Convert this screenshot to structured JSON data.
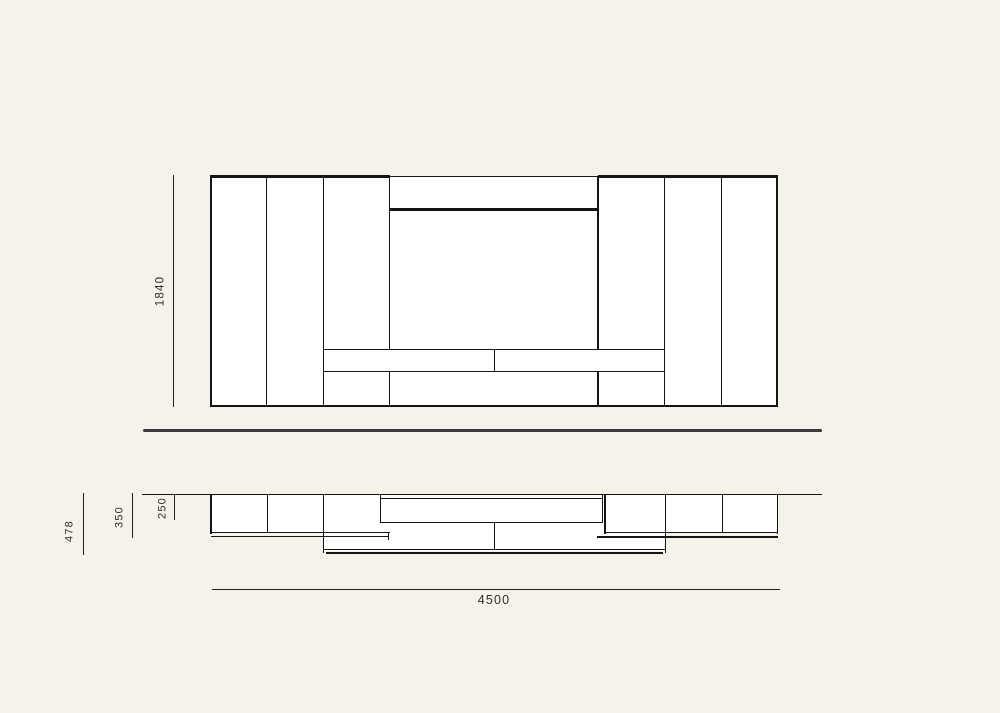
{
  "diagram": {
    "front_view": {
      "height_dim": "1840"
    },
    "plan_view": {
      "depth_dim_478": "478",
      "depth_dim_350": "350",
      "depth_dim_250": "250",
      "width_dim": "4500"
    }
  },
  "colors": {
    "background": "#f4f2e9",
    "surface": "#ffffff",
    "line": "#141414",
    "separator": "#3a3a3a",
    "dim_line": "#222222",
    "dim_text": "#2d2d2d"
  }
}
